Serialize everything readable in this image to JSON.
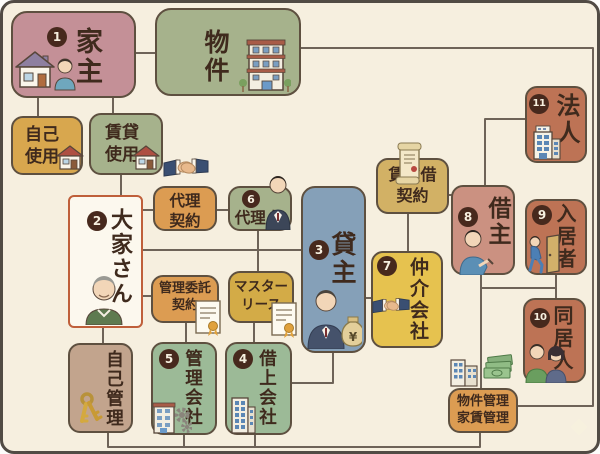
{
  "palette": {
    "background": "#f6efdf",
    "frame": "#514b44",
    "connector": "#6e6358",
    "text": "#3f2a1d",
    "badge_bg": "#47291d",
    "badge_text": "#f6efdf",
    "landlord_border": "#bf5f3a"
  },
  "nodes": {
    "house_owner": {
      "badge": "1",
      "label": "家主",
      "color": "#c49097"
    },
    "property": {
      "label": "物件",
      "color": "#a6b28c"
    },
    "self_use": {
      "line1": "自己",
      "line2": "使用",
      "color": "#d8a74e"
    },
    "rental_use": {
      "line1": "賃貸",
      "line2": "使用",
      "color": "#a6b28c"
    },
    "landlord": {
      "badge": "2",
      "label": "大家さん",
      "color": "#fcf8ee"
    },
    "agency_contract": {
      "line1": "代理",
      "line2": "契約",
      "color": "#dc9c52"
    },
    "agent": {
      "badge": "6",
      "label": "代理人",
      "color": "#a6b28c"
    },
    "lessor": {
      "badge": "3",
      "label": "貸主",
      "color": "#85a0b8"
    },
    "lease_contract": {
      "line1": "賃貸借",
      "line2": "契約",
      "color": "#d2b165"
    },
    "brokerage_company": {
      "badge": "7",
      "label": "仲介会社",
      "color": "#e6c24f"
    },
    "lessee": {
      "badge": "8",
      "label": "借主",
      "color": "#cb9181"
    },
    "corporation": {
      "badge": "11",
      "label": "法人",
      "color": "#bd7355"
    },
    "resident": {
      "badge": "9",
      "label": "入居者",
      "color": "#bd7355"
    },
    "cohabitant": {
      "badge": "10",
      "label": "同居人",
      "color": "#bd7355"
    },
    "management_contract": {
      "line1": "管理委託",
      "line2": "契約",
      "color": "#dc9c52"
    },
    "master_lease": {
      "line1": "マスター",
      "line2": "リース",
      "color": "#d3ab47"
    },
    "self_management": {
      "label": "自己管理",
      "color": "#c2a48d"
    },
    "management_company": {
      "badge": "5",
      "label": "管理会社",
      "color": "#9cba97"
    },
    "leasing_company": {
      "badge": "4",
      "label": "借上会社",
      "color": "#9cba97"
    },
    "property_rent_management": {
      "line1": "物件管理",
      "line2": "家賃管理",
      "color": "#dc9c52"
    }
  }
}
